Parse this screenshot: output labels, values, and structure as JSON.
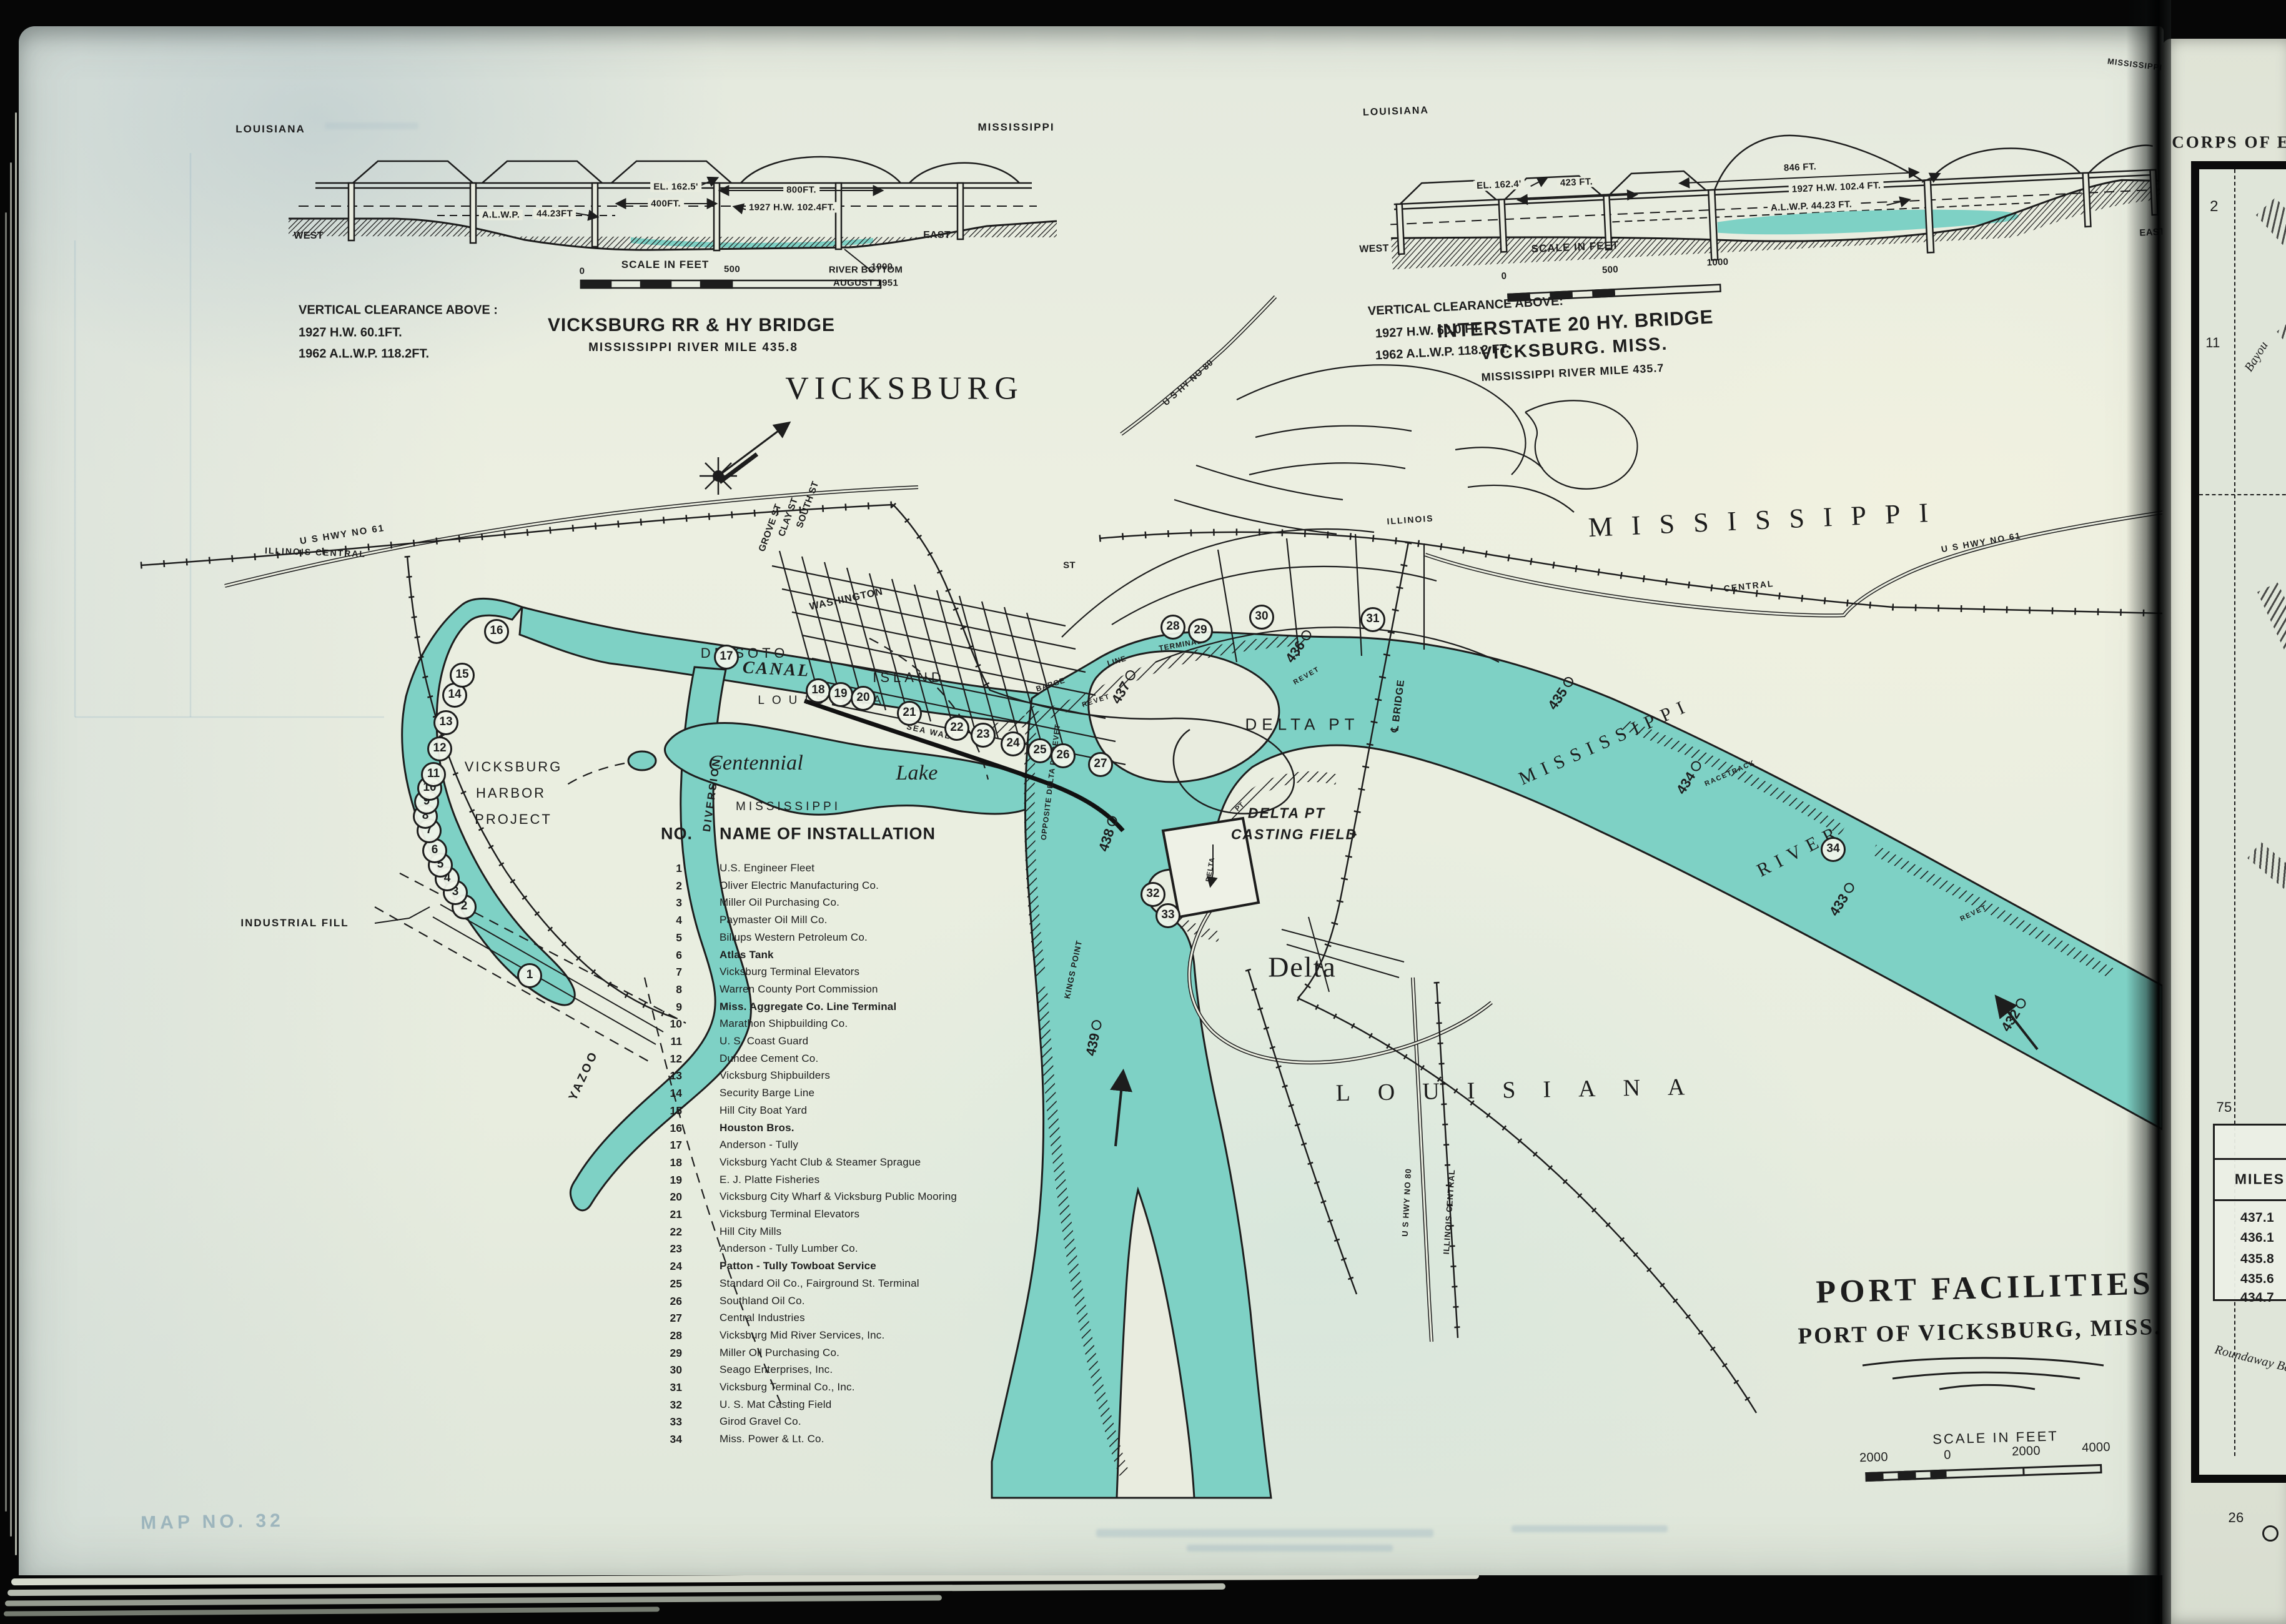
{
  "bridges": {
    "left": {
      "state_left": "LOUISIANA",
      "state_right": "MISSISSIPPI",
      "west": "WEST",
      "east": "EAST",
      "el": "EL. 162.5'",
      "d400": "400FT.",
      "d800": "800FT.",
      "hw": "1927 H.W. 102.4FT.",
      "alwp": "A.L.W.P.",
      "alwp_v": "44.23FT",
      "rb1": "RIVER BOTTOM",
      "rb2": "AUGUST 1951",
      "scale": "SCALE IN FEET",
      "s0": "0",
      "s500": "500",
      "s1000": "1000",
      "vc": "VERTICAL CLEARANCE ABOVE :",
      "vc1": "1927 H.W. 60.1FT.",
      "vc2": "1962 A.L.W.P. 118.2FT.",
      "title": "VICKSBURG RR & HY BRIDGE",
      "sub": "MISSISSIPPI RIVER    MILE 435.8"
    },
    "right": {
      "state_left": "LOUISIANA",
      "corner": "MISSISSIPPI",
      "west": "WEST",
      "east": "EAST",
      "el": "EL. 162.4'",
      "d423": "423 FT.",
      "d846": "846 FT.",
      "hw": "1927 H.W. 102.4 FT.",
      "alwp": "A.L.W.P.  44.23 FT.",
      "scale": "SCALE IN FEET",
      "s0": "0",
      "s500": "500",
      "s1000": "1000",
      "vc": "VERTICAL CLEARANCE ABOVE:",
      "vc1": "1927 H.W. 60.0 FT.",
      "vc2": "1962 A.L.W.P. 118.2 FT.",
      "title": "INTERSTATE 20 HY. BRIDGE",
      "sub": "VICKSBURG. MISS.",
      "sub2": "MISSISSIPPI RIVER  MILE 435.7"
    }
  },
  "map": {
    "city": "VICKSBURG",
    "labels": {
      "hwy61_l": "U S HWY NO 61",
      "ic_l": "ILLINOIS CENTRAL",
      "hy80": "U S HY NO 80",
      "south": "SOUTH ST",
      "clay": "CLAY ST",
      "grove": "GROVE ST",
      "washington": "WASHINGTON",
      "st": "ST",
      "illinois": "ILLINOIS",
      "central": "CENTRAL",
      "hwy61_r": "U S HWY NO 61",
      "state_ms": "MISSISSIPPI",
      "sea_wall": "SEA WALL",
      "canal": "CANAL",
      "de_soto": "DE SOTO",
      "island": "ISLAND",
      "state_la_island": "LOUISIANA",
      "centennial": "Centennial",
      "lake": "Lake",
      "ms_small": "MISSISSIPPI",
      "diversion": "DIVERSION",
      "yazoo": "YAZOO",
      "industrial": "INDUSTRIAL FILL",
      "harbor1": "VICKSBURG",
      "harbor2": "HARBOR",
      "harbor3": "PROJECT",
      "delta_pt": "DELTA PT",
      "cast1": "DELTA PT",
      "cast2": "CASTING FIELD",
      "delta_town": "Delta",
      "state_la": "LOUISIANA",
      "ms_river1": "MISSISSIPPI",
      "ms_river2": "RIVER",
      "racetrack": "RACETRACK",
      "revet": "REVET",
      "opposite": "OPPOSITE DELTA PT REVET",
      "kings": "KINGS POINT",
      "barge": "BARGE",
      "line": "LINE",
      "terminal": "TERMINAL",
      "cl_bridge": "℄ BRIDGE",
      "hwy80_s": "U S HWY NO 80",
      "ic_s": "ILLINOIS CENTRAL",
      "delta_v": "DELTA",
      "pt_v": "PT"
    },
    "list": {
      "h_no": "NO.",
      "h_name": "NAME OF INSTALLATION",
      "items": [
        {
          "no": "1",
          "name": "U.S. Engineer Fleet"
        },
        {
          "no": "2",
          "name": "Oliver Electric Manufacturing Co."
        },
        {
          "no": "3",
          "name": "Miller Oil Purchasing Co."
        },
        {
          "no": "4",
          "name": "Paymaster Oil Mill Co."
        },
        {
          "no": "5",
          "name": "Billups Western Petroleum Co."
        },
        {
          "no": "6",
          "name": "Atlas Tank"
        },
        {
          "no": "7",
          "name": "Vicksburg Terminal Elevators"
        },
        {
          "no": "8",
          "name": "Warren County Port Commission"
        },
        {
          "no": "9",
          "name": "Miss. Aggregate Co. Line Terminal"
        },
        {
          "no": "10",
          "name": "Marathon Shipbuilding Co."
        },
        {
          "no": "11",
          "name": "U. S. Coast Guard"
        },
        {
          "no": "12",
          "name": "Dundee Cement Co."
        },
        {
          "no": "13",
          "name": "Vicksburg Shipbuilders"
        },
        {
          "no": "14",
          "name": "Security Barge Line"
        },
        {
          "no": "15",
          "name": "Hill City Boat Yard"
        },
        {
          "no": "16",
          "name": "Houston Bros."
        },
        {
          "no": "17",
          "name": "Anderson - Tully"
        },
        {
          "no": "18",
          "name": "Vicksburg Yacht Club & Steamer Sprague"
        },
        {
          "no": "19",
          "name": "E. J. Platte Fisheries"
        },
        {
          "no": "20",
          "name": "Vicksburg City Wharf & Vicksburg Public Mooring"
        },
        {
          "no": "21",
          "name": "Vicksburg Terminal Elevators"
        },
        {
          "no": "22",
          "name": "Hill City Mills"
        },
        {
          "no": "23",
          "name": "Anderson - Tully Lumber Co."
        },
        {
          "no": "24",
          "name": "Patton - Tully Towboat Service"
        },
        {
          "no": "25",
          "name": "Standard Oil Co., Fairground St. Terminal"
        },
        {
          "no": "26",
          "name": "Southland Oil Co."
        },
        {
          "no": "27",
          "name": "Central Industries"
        },
        {
          "no": "28",
          "name": "Vicksburg Mid River Services, Inc."
        },
        {
          "no": "29",
          "name": "Miller Oil Purchasing Co."
        },
        {
          "no": "30",
          "name": "Seago Enterprises, Inc."
        },
        {
          "no": "31",
          "name": "Vicksburg Terminal Co., Inc."
        },
        {
          "no": "32",
          "name": "U. S. Mat Casting Field"
        },
        {
          "no": "33",
          "name": "Girod Gravel Co."
        },
        {
          "no": "34",
          "name": "Miss. Power & Lt. Co."
        }
      ]
    },
    "markers": [
      "1",
      "2",
      "3",
      "4",
      "5",
      "6",
      "7",
      "8",
      "9",
      "10",
      "11",
      "12",
      "13",
      "14",
      "15",
      "16",
      "17",
      "18",
      "19",
      "20",
      "21",
      "22",
      "23",
      "24",
      "25",
      "26",
      "27",
      "28",
      "29",
      "30",
      "31",
      "32",
      "33",
      "34"
    ],
    "miles": [
      "432",
      "433",
      "434",
      "435",
      "436",
      "437",
      "438",
      "439"
    ],
    "ghost": "MAP NO. 32"
  },
  "title_block": {
    "title": "PORT FACILITIES",
    "subtitle": "PORT OF VICKSBURG, MISS.",
    "scale": "SCALE IN FEET",
    "s": [
      "2000",
      "0",
      "2000",
      "4000"
    ]
  },
  "page2": {
    "header": "CORPS OF E",
    "g2": "2",
    "g1": "1",
    "g11": "11",
    "bayou": "Bayou",
    "n75": "75",
    "miles_h": "MILES",
    "miles": [
      "437.1",
      "436.1",
      "435.8",
      "435.6",
      "434.7"
    ],
    "bayou2": "Roundaway Ba",
    "n26": "26"
  }
}
